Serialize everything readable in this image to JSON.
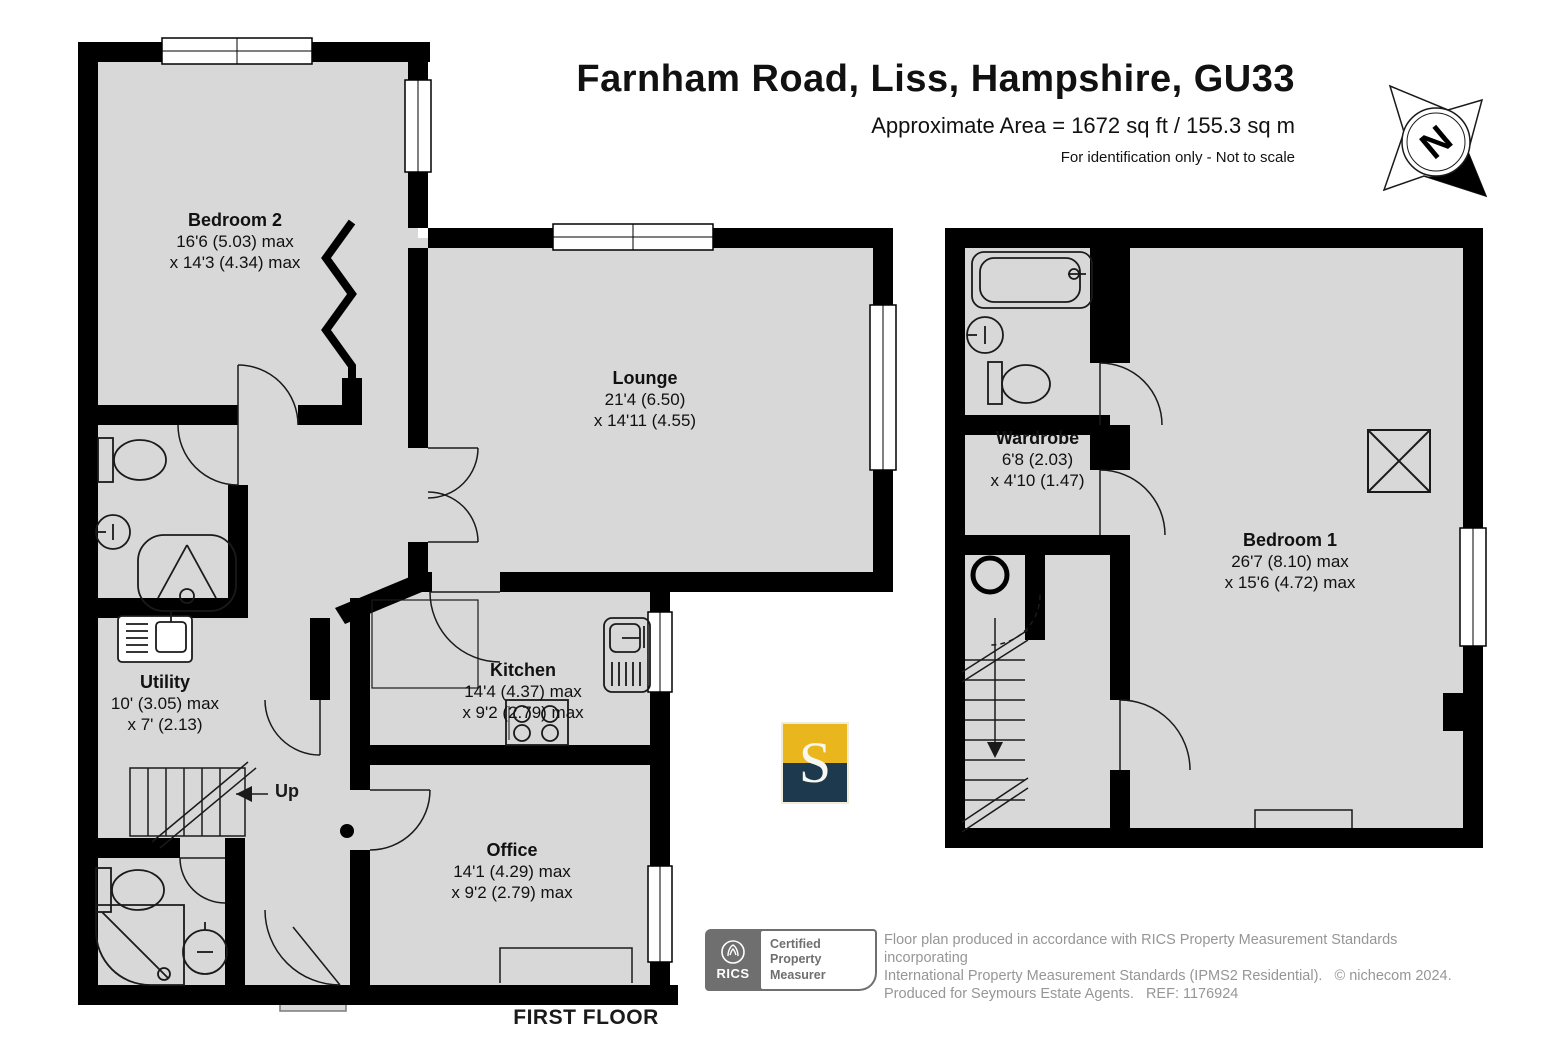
{
  "header": {
    "title": "Farnham Road, Liss, Hampshire, GU33",
    "area": "Approximate Area = 1672 sq ft / 155.3 sq m",
    "disclaimer": "For identification only - Not to scale"
  },
  "compass": {
    "label": "N"
  },
  "plan": {
    "floor_label": "FIRST FLOOR",
    "up_label": "Up",
    "rooms": [
      {
        "name": "Bedroom 2",
        "dim1": "16'6 (5.03) max",
        "dim2": "x 14'3 (4.34) max"
      },
      {
        "name": "Lounge",
        "dim1": "21'4 (6.50)",
        "dim2": "x 14'11 (4.55)"
      },
      {
        "name": "Kitchen",
        "dim1": "14'4 (4.37) max",
        "dim2": "x 9'2 (2.79) max"
      },
      {
        "name": "Office",
        "dim1": "14'1 (4.29) max",
        "dim2": "x 9'2 (2.79) max"
      },
      {
        "name": "Utility",
        "dim1": "10' (3.05) max",
        "dim2": "x 7' (2.13)"
      },
      {
        "name": "Wardrobe",
        "dim1": "6'8 (2.03)",
        "dim2": "x 4'10 (1.47)"
      },
      {
        "name": "Bedroom 1",
        "dim1": "26'7 (8.10) max",
        "dim2": "x 15'6 (4.72) max"
      }
    ]
  },
  "branding": {
    "seymours_letter": "S",
    "rics": {
      "brand": "RICS",
      "lines": [
        "Certified",
        "Property",
        "Measurer"
      ]
    }
  },
  "footer": {
    "line1": "Floor plan produced in accordance with RICS Property Measurement Standards incorporating",
    "line2": "International Property Measurement Standards (IPMS2 Residential).   © nichecom 2024.",
    "line3": "Produced for Seymours Estate Agents.   REF: 1176924"
  },
  "colors": {
    "floor_gray": "#d8d8d8",
    "wall_black": "#000000",
    "seymours_gold": "#eab61e",
    "seymours_navy": "#1c394e",
    "footer_gray": "#969696",
    "rics_gray": "#6f6f6f"
  }
}
